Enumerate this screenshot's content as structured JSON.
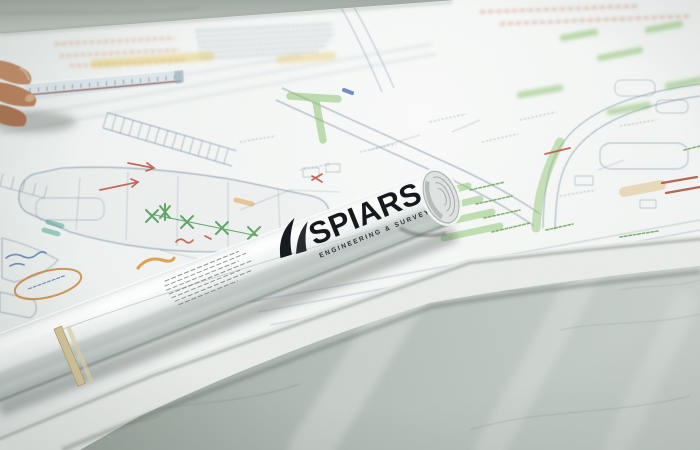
{
  "scene": {
    "type": "photograph",
    "description": "A rolled engineering drawing tube printed with the SPIARS ENGINEERING & SURVEYING logo lies diagonally across civil site plans covered in green, orange and red reviewer markups, spread on a grey marble countertop; a hand holding a scale ruler reaches in from the top left.",
    "surface": "marble countertop",
    "objects": [
      "site plan blueprint sheets",
      "rolled drawing tube",
      "rubber band",
      "hand with scale ruler"
    ]
  },
  "tube": {
    "brand": "SPIARS",
    "tagline": "ENGINEERING & SURVEYING"
  },
  "palette": {
    "countertop": "#b7c0ba",
    "marble_vein": "#93a29a",
    "paper": "#f3f5f3",
    "drawing_line": "#7d92a8",
    "highlight_green": "#84c066",
    "highlight_yellow": "#e6c44e",
    "highlight_orange": "#d98f2b",
    "annotation_red": "#bf4434",
    "pen_blue": "#4a6fb0",
    "logo_black": "#16191d",
    "skin_tone": "#c28e6b",
    "rubber_band": "#d3c59c"
  }
}
